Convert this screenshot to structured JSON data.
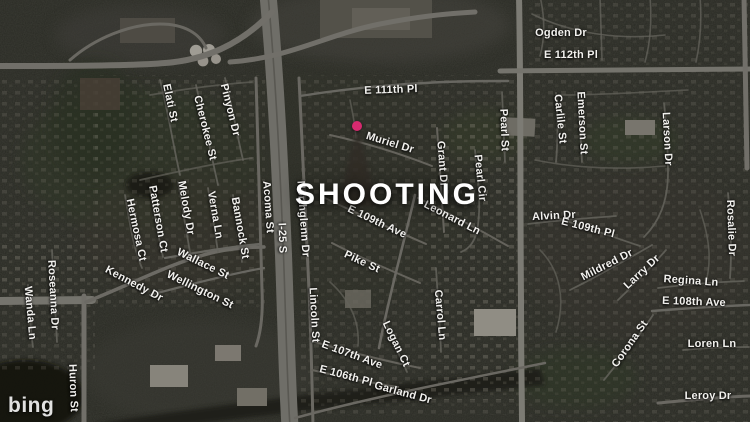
{
  "headline": {
    "text": "SHOOTING"
  },
  "pin": {
    "color": "#d62a6f"
  },
  "logo": {
    "text": "bing"
  },
  "map": {
    "labels": [
      {
        "text": "Elati St",
        "x": 170,
        "y": 103,
        "r": 78
      },
      {
        "text": "Cherokee St",
        "x": 205,
        "y": 128,
        "r": 76
      },
      {
        "text": "Pinyon Dr",
        "x": 230,
        "y": 110,
        "r": 76
      },
      {
        "text": "Hermosa Ct",
        "x": 136,
        "y": 230,
        "r": 78
      },
      {
        "text": "Patterson Ct",
        "x": 158,
        "y": 219,
        "r": 80
      },
      {
        "text": "Melody Dr",
        "x": 186,
        "y": 208,
        "r": 80
      },
      {
        "text": "Verna Ln",
        "x": 215,
        "y": 215,
        "r": 80
      },
      {
        "text": "Bannock St",
        "x": 240,
        "y": 228,
        "r": 80
      },
      {
        "text": "Acoma St",
        "x": 268,
        "y": 207,
        "r": 86
      },
      {
        "text": "I-25 S",
        "x": 282,
        "y": 238,
        "r": 88
      },
      {
        "text": "Northglenn Dr",
        "x": 303,
        "y": 219,
        "r": 86
      },
      {
        "text": "Wallace St",
        "x": 203,
        "y": 264,
        "r": 26
      },
      {
        "text": "Wellington St",
        "x": 200,
        "y": 290,
        "r": 26
      },
      {
        "text": "Kennedy Dr",
        "x": 134,
        "y": 284,
        "r": 28
      },
      {
        "text": "Roseanna Dr",
        "x": 53,
        "y": 295,
        "r": 87
      },
      {
        "text": "Wanda Ln",
        "x": 30,
        "y": 313,
        "r": 85
      },
      {
        "text": "Huron St",
        "x": 73,
        "y": 388,
        "r": 88
      },
      {
        "text": "E 111th Pl",
        "x": 391,
        "y": 90,
        "r": -2
      },
      {
        "text": "Muriel Dr",
        "x": 390,
        "y": 143,
        "r": 17
      },
      {
        "text": "Grant Dr",
        "x": 442,
        "y": 164,
        "r": 86
      },
      {
        "text": "Pearl Cir",
        "x": 480,
        "y": 178,
        "r": 84
      },
      {
        "text": "Pearl St",
        "x": 504,
        "y": 130,
        "r": 88
      },
      {
        "text": "Leonard Ln",
        "x": 452,
        "y": 218,
        "r": 27
      },
      {
        "text": "E 109th Ave",
        "x": 377,
        "y": 222,
        "r": 25
      },
      {
        "text": "Pike St",
        "x": 362,
        "y": 262,
        "r": 25
      },
      {
        "text": "Lincoln St",
        "x": 314,
        "y": 315,
        "r": 87
      },
      {
        "text": "Logan Ct",
        "x": 396,
        "y": 344,
        "r": 64
      },
      {
        "text": "Carrol Ln",
        "x": 440,
        "y": 315,
        "r": 85
      },
      {
        "text": "E 107th Ave",
        "x": 352,
        "y": 355,
        "r": 20
      },
      {
        "text": "E 106th Pl",
        "x": 346,
        "y": 376,
        "r": 15
      },
      {
        "text": "Garland Dr",
        "x": 403,
        "y": 393,
        "r": 15
      },
      {
        "text": "Ogden Dr",
        "x": 561,
        "y": 33,
        "r": 0
      },
      {
        "text": "E 112th Pl",
        "x": 571,
        "y": 55,
        "r": 0
      },
      {
        "text": "Carlile St",
        "x": 560,
        "y": 119,
        "r": 84
      },
      {
        "text": "Emerson St",
        "x": 582,
        "y": 123,
        "r": 87
      },
      {
        "text": "Larson Dr",
        "x": 667,
        "y": 139,
        "r": 87
      },
      {
        "text": "Rosalie Dr",
        "x": 731,
        "y": 228,
        "r": 88
      },
      {
        "text": "Alvin Dr",
        "x": 554,
        "y": 216,
        "r": -3
      },
      {
        "text": "E 109th Pl",
        "x": 588,
        "y": 228,
        "r": 14
      },
      {
        "text": "Mildred Dr",
        "x": 607,
        "y": 265,
        "r": -27
      },
      {
        "text": "Larry Dr",
        "x": 642,
        "y": 272,
        "r": -43
      },
      {
        "text": "Regina Ln",
        "x": 691,
        "y": 281,
        "r": 4
      },
      {
        "text": "E 108th Ave",
        "x": 694,
        "y": 302,
        "r": 2
      },
      {
        "text": "Corona St",
        "x": 630,
        "y": 344,
        "r": -55
      },
      {
        "text": "Loren Ln",
        "x": 712,
        "y": 344,
        "r": 0
      },
      {
        "text": "Leroy Dr",
        "x": 708,
        "y": 396,
        "r": 0
      }
    ]
  }
}
